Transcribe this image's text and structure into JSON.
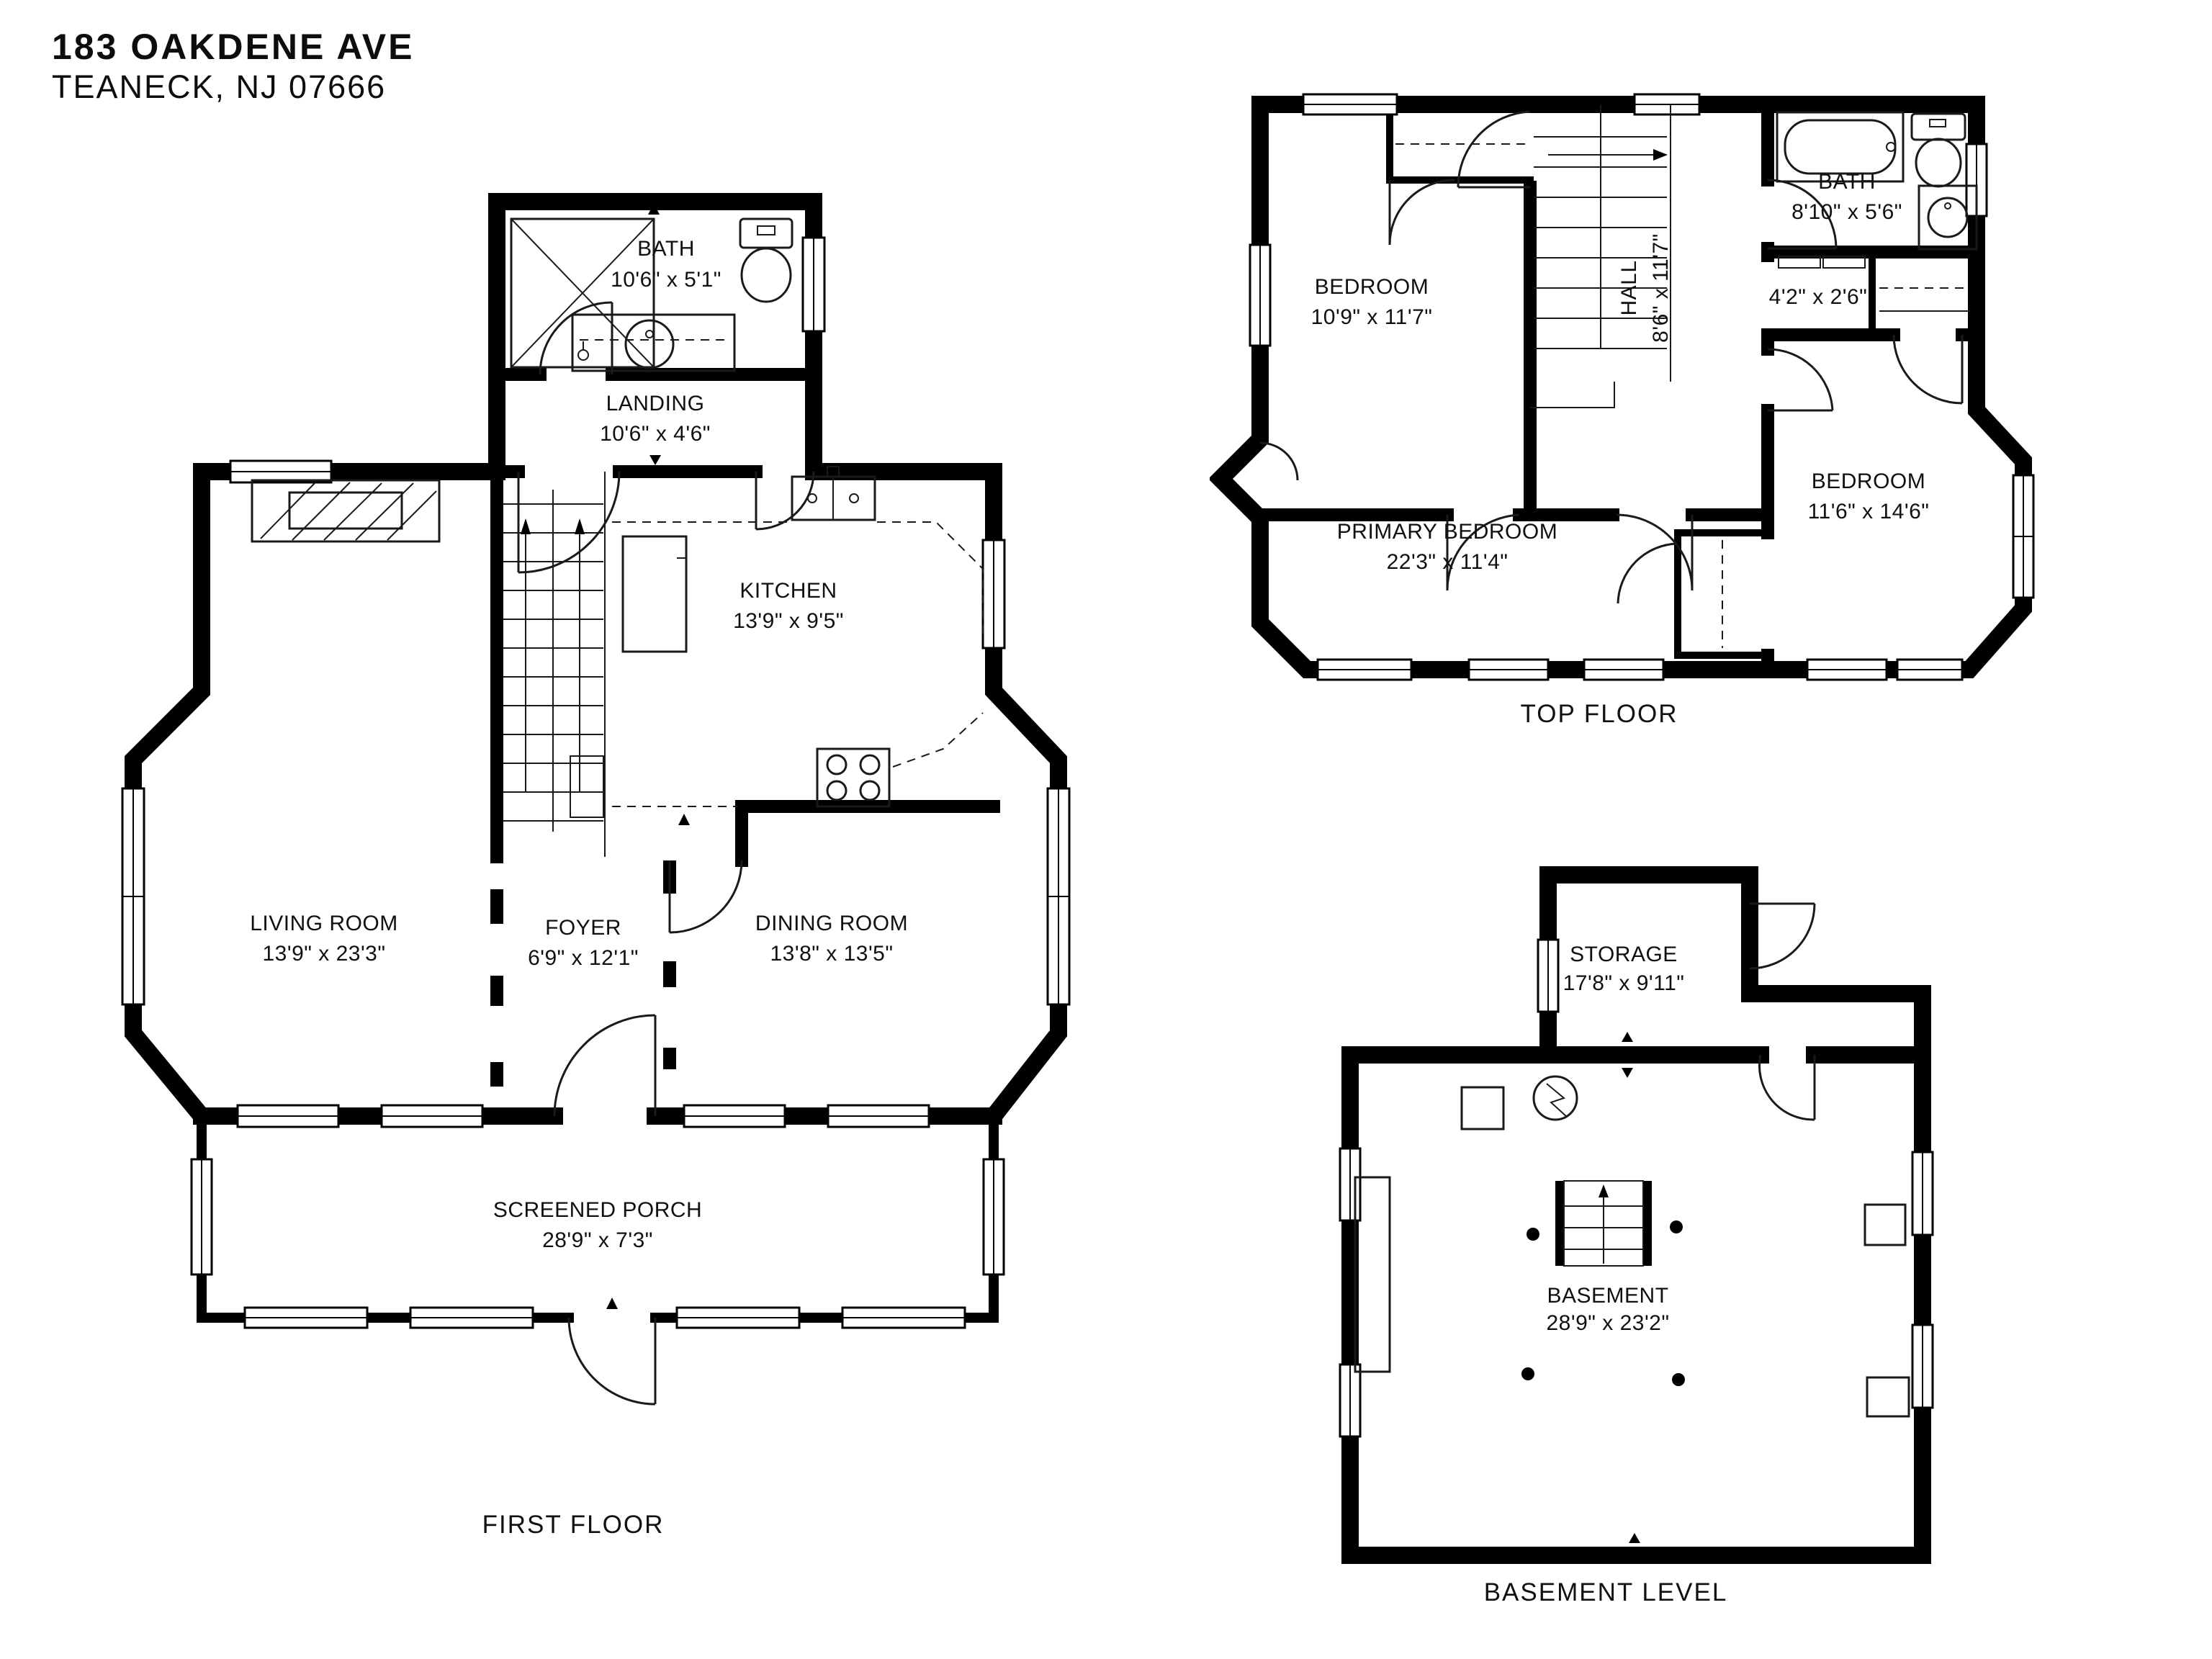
{
  "header": {
    "address_line1": "183 OAKDENE AVE",
    "address_line2": "TEANECK, NJ 07666"
  },
  "colors": {
    "walls": "#000000",
    "background": "#ffffff",
    "fixture_lines": "#1a1a1a",
    "text": "#101010"
  },
  "floors": [
    {
      "name": "FIRST FLOOR",
      "rooms": [
        {
          "name": "BATH",
          "dims": "10'6\" x 5'1\""
        },
        {
          "name": "LANDING",
          "dims": "10'6\" x 4'6\""
        },
        {
          "name": "KITCHEN",
          "dims": "13'9\" x 9'5\""
        },
        {
          "name": "LIVING ROOM",
          "dims": "13'9\" x 23'3\""
        },
        {
          "name": "FOYER",
          "dims": "6'9\" x 12'1\""
        },
        {
          "name": "DINING ROOM",
          "dims": "13'8\" x 13'5\""
        },
        {
          "name": "SCREENED PORCH",
          "dims": "28'9\" x 7'3\""
        }
      ]
    },
    {
      "name": "TOP FLOOR",
      "rooms": [
        {
          "name": "BEDROOM",
          "dims": "10'9\" x 11'7\""
        },
        {
          "name": "HALL",
          "dims": "8'6\" x 11'7\""
        },
        {
          "name": "BATH",
          "dims": "8'10\" x 5'6\""
        },
        {
          "dims": "4'2\" x 2'6\""
        },
        {
          "name": "PRIMARY BEDROOM",
          "dims": "22'3\" x 11'4\""
        },
        {
          "name": "BEDROOM",
          "dims": "11'6\" x 14'6\""
        }
      ]
    },
    {
      "name": "BASEMENT LEVEL",
      "rooms": [
        {
          "name": "STORAGE",
          "dims": "17'8\" x 9'11\""
        },
        {
          "name": "BASEMENT",
          "dims": "28'9\" x 23'2\""
        }
      ]
    }
  ]
}
